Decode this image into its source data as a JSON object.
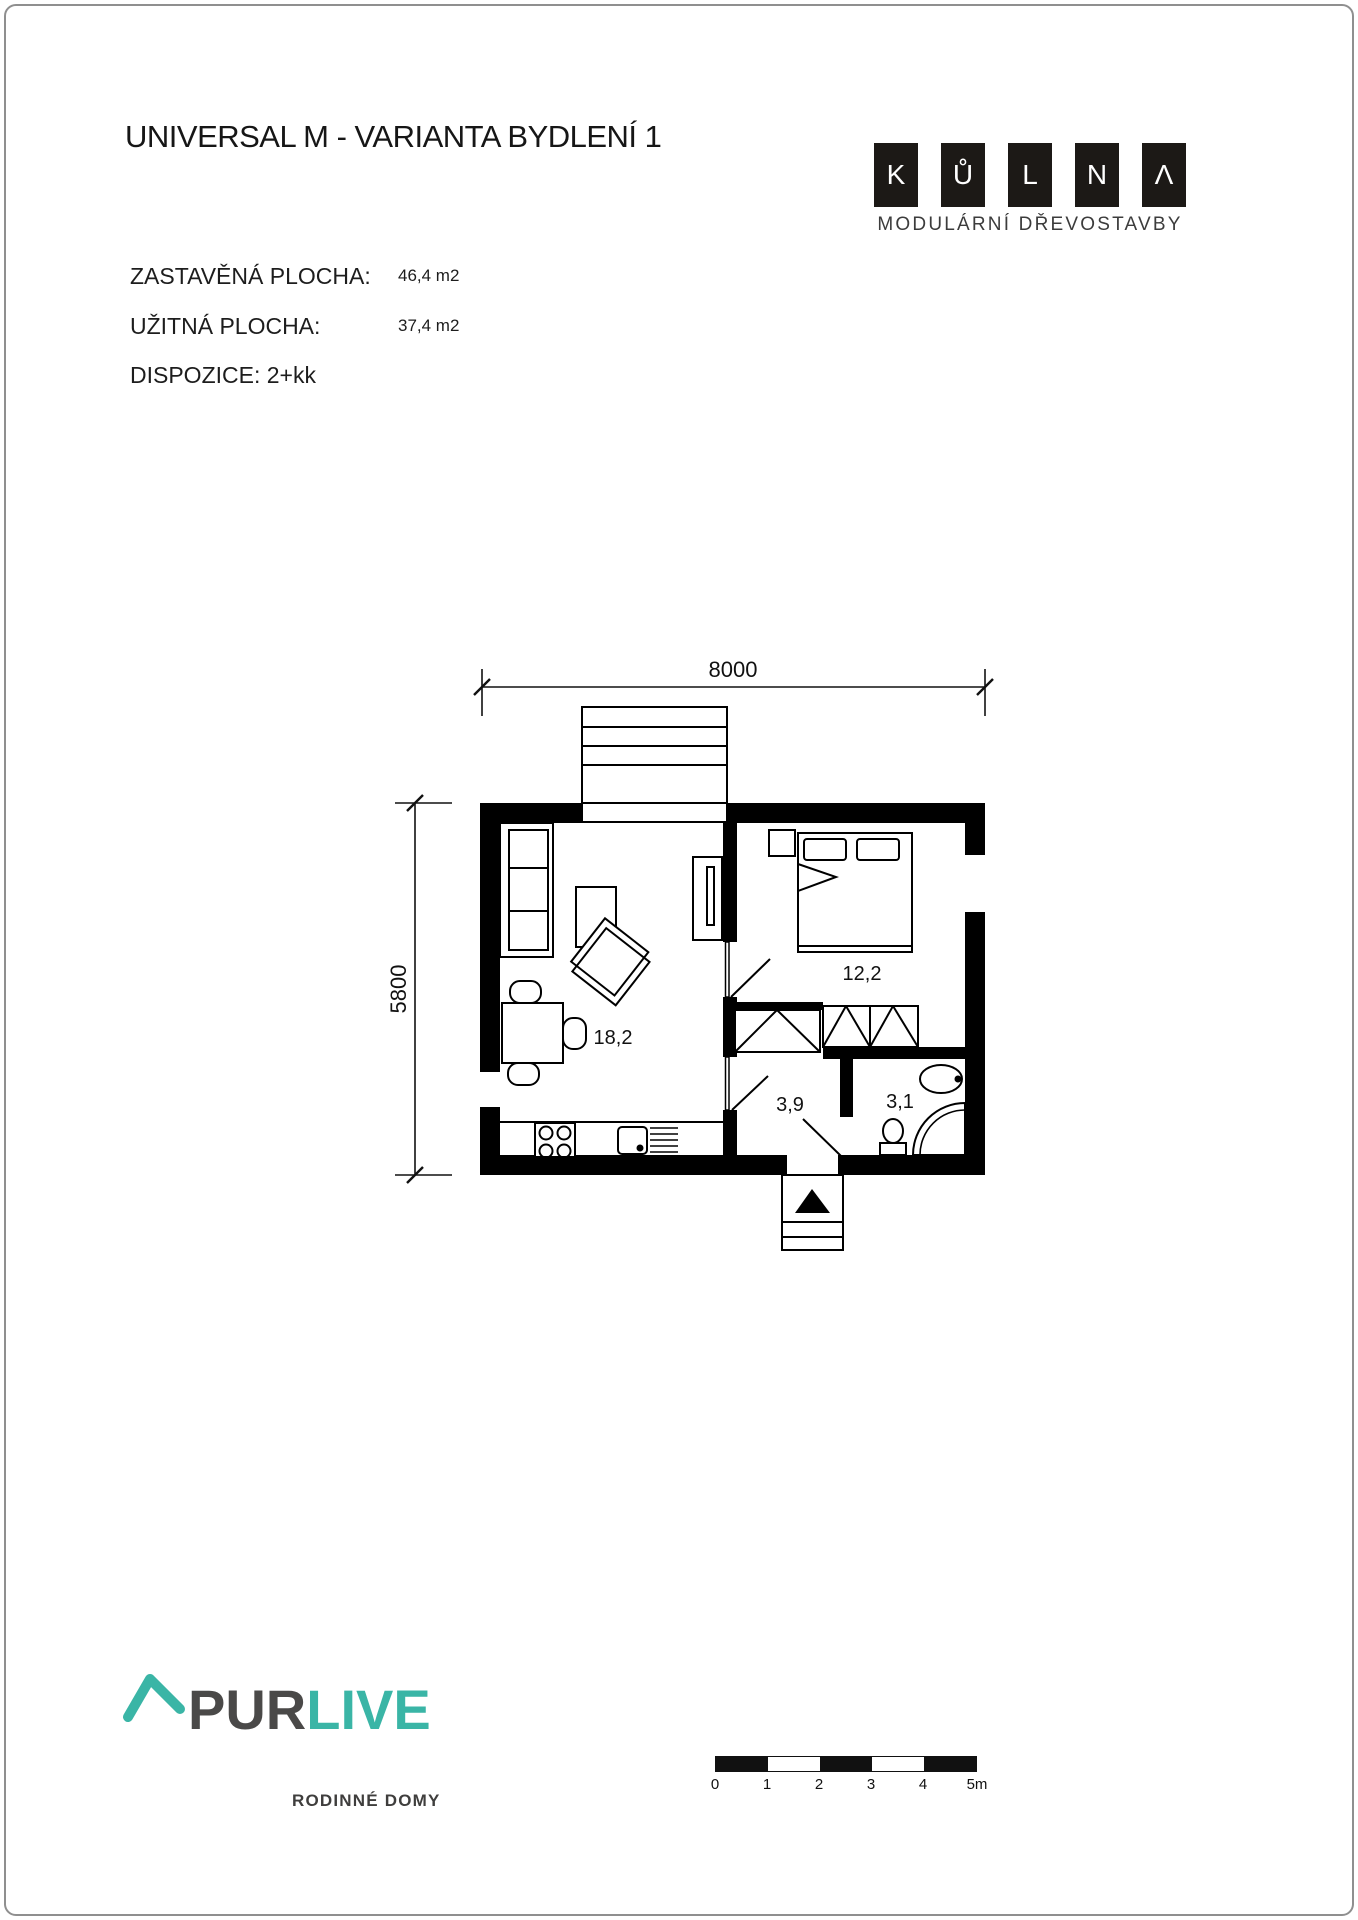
{
  "page": {
    "title": "UNIVERSAL M - VARIANTA BYDLENÍ 1"
  },
  "brand": {
    "logo_letters": [
      "K",
      "Ů",
      "L",
      "N",
      "Λ"
    ],
    "logo_subtitle": "MODULÁRNÍ DŘEVOSTAVBY"
  },
  "specs": {
    "built": {
      "label": "ZASTAVĚNÁ PLOCHA:",
      "value": "46,4 m2"
    },
    "usable": {
      "label": "UŽITNÁ PLOCHA:",
      "value": "37,4 m2"
    },
    "layout": {
      "label": "DISPOZICE: 2+kk"
    }
  },
  "plan": {
    "dimensions": {
      "width": "8000",
      "height": "5800"
    },
    "rooms": {
      "living": "18,2",
      "bedroom": "12,2",
      "hall": "3,9",
      "bath": "3,1"
    }
  },
  "scalebar": {
    "ticks": [
      "0",
      "1",
      "2",
      "3",
      "4",
      "5m"
    ]
  },
  "footer": {
    "brand_prefix": "PUR",
    "brand_suffix": "LIVE",
    "tagline": "RODINNÉ DOMY"
  },
  "colors": {
    "accent_teal": "#3ab5a6",
    "brand_dark": "#4a4948",
    "ink": "#111111"
  }
}
